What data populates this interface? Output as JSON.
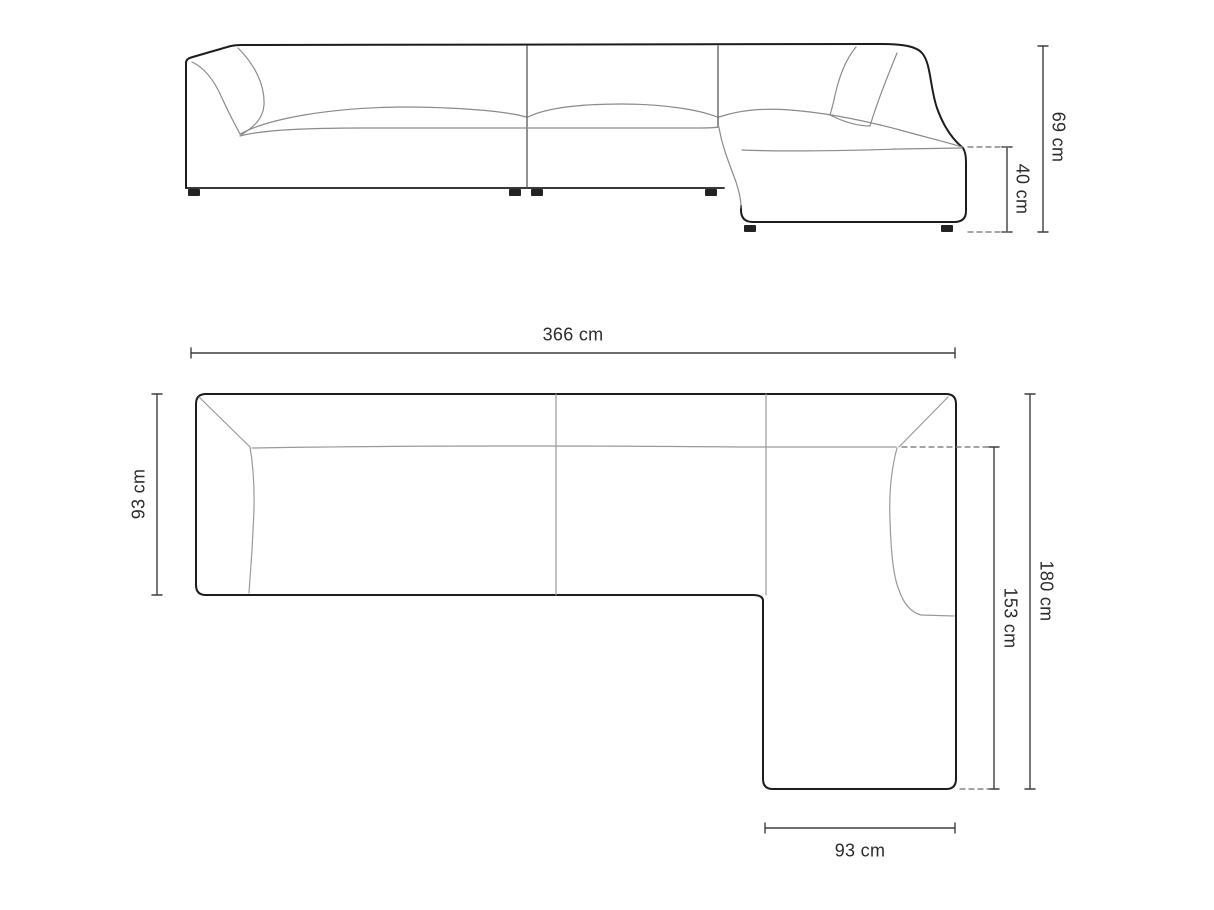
{
  "diagram": {
    "type": "furniture-technical-drawing",
    "subject": "modular corner sofa with right chaise",
    "views": {
      "elevation": "front elevation view",
      "plan": "top plan view"
    },
    "labels": {
      "elevation_total_height": "69 cm",
      "elevation_seat_height": "40 cm",
      "plan_total_width": "366 cm",
      "plan_depth": "93 cm",
      "plan_side_total_length": "180 cm",
      "plan_side_inner_length": "153 cm",
      "plan_chaise_width": "93 cm"
    },
    "colors": {
      "background": "#ffffff",
      "outline": "#1c1c1c",
      "seam_line": "#9a9a9a",
      "soft_line": "#8a8a8a",
      "dimension_line": "#3f3f3f",
      "dashed_line": "#6e6e6e",
      "label_text": "#2b2b2b"
    }
  }
}
